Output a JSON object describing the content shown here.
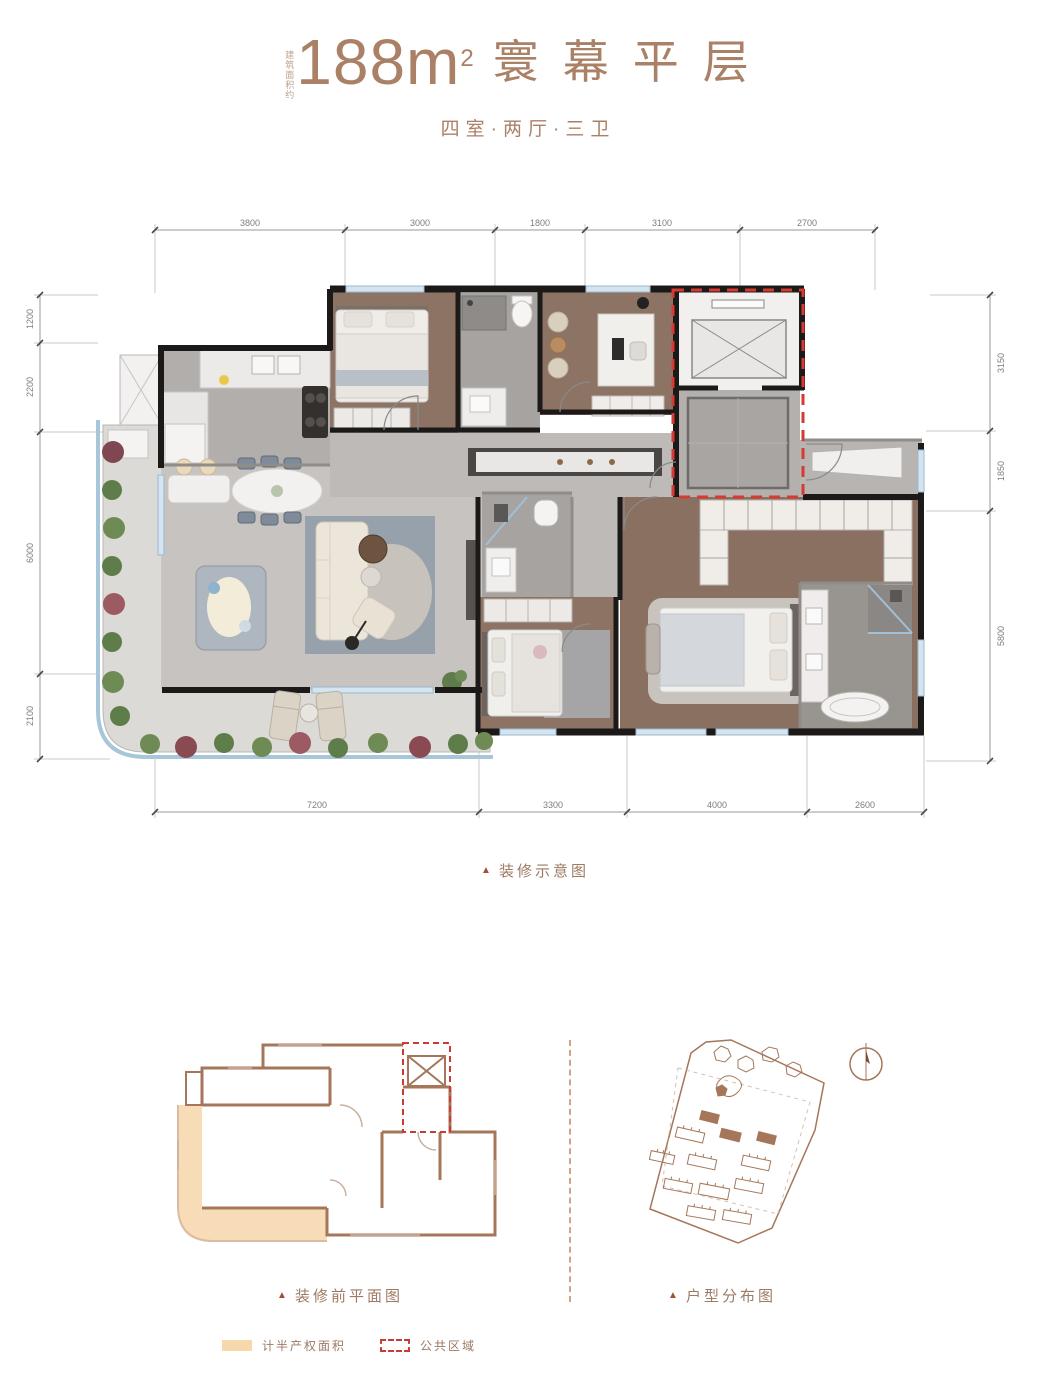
{
  "header": {
    "area_prefix": "建筑面积约",
    "area_value": "188m",
    "area_exponent": "2",
    "title": "寰幕平层",
    "subtitle": "四室·两厅·三卫"
  },
  "main_plan": {
    "caption_marker": "▲",
    "caption": "装修示意图",
    "dims_top": [
      "3800",
      "3000",
      "1800",
      "3100",
      "2700"
    ],
    "dims_bottom": [
      "7200",
      "3300",
      "4000",
      "2600"
    ],
    "dims_left": [
      "1200",
      "2200",
      "6000",
      "2100"
    ],
    "dims_right": [
      "3150",
      "1850",
      "5800"
    ]
  },
  "before_plan": {
    "caption_marker": "▲",
    "caption": "装修前平面图"
  },
  "site_plan": {
    "caption_marker": "▲",
    "caption": "户型分布图"
  },
  "legend": {
    "half_property_label": "计半产权面积",
    "public_area_label": "公共区域"
  },
  "colors": {
    "title_brown": "#aa8066",
    "caption_brown": "#9d7a64",
    "public_area_red": "#cc3b33",
    "half_property_orange": "#f7d8ad",
    "outline_brown": "#a5765a",
    "wood_floor": "#8c7363",
    "tile_gray": "#c6c3c0",
    "wall_black": "#1c1a18",
    "window_blue": "#d4e4f0"
  }
}
